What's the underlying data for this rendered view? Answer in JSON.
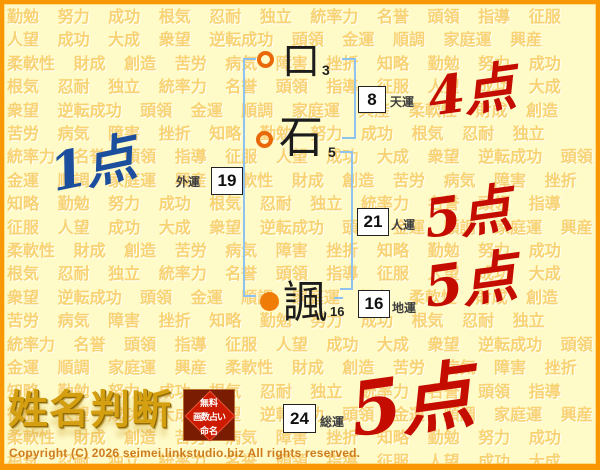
{
  "page": {
    "background_color": "#FFFBC9",
    "frame_color": "#F99803",
    "bracket_color": "#8FC2EE"
  },
  "watermark": {
    "color": "#F6C858",
    "words": [
      "勤勉",
      "努力",
      "成功",
      "根気",
      "忍耐",
      "独立",
      "統率力",
      "名誉",
      "頭領",
      "指導",
      "征服",
      "人望",
      "成功",
      "大成",
      "衆望",
      "逆転成功",
      "頭領",
      "金運",
      "順調",
      "家庭運",
      "興産",
      "柔軟性",
      "財成",
      "創造",
      "苦労",
      "病気",
      "障害",
      "挫折",
      "知略"
    ]
  },
  "name_chart": {
    "surname": [
      {
        "char": "口",
        "strokes": "3",
        "marker": "open-circle"
      },
      {
        "char": "石",
        "strokes": "5",
        "marker": "open-circle"
      }
    ],
    "given_name": [
      {
        "char": "諷",
        "strokes": "16",
        "marker": "filled-circle"
      }
    ],
    "fortunes": [
      {
        "id": "tenun",
        "label": "天運",
        "value": "8",
        "score": "4点",
        "score_color": "#C40D00"
      },
      {
        "id": "gaiun",
        "label": "外運",
        "value": "19",
        "score": "1点",
        "score_color": "#1C4E9E"
      },
      {
        "id": "jinun",
        "label": "人運",
        "value": "21",
        "score": "5点",
        "score_color": "#C40D00"
      },
      {
        "id": "chiun",
        "label": "地運",
        "value": "16",
        "score": "5点",
        "score_color": "#C40D00"
      },
      {
        "id": "soun",
        "label": "総運",
        "value": "24",
        "score": "5点",
        "score_color": "#C40D00"
      }
    ]
  },
  "logo": {
    "title": "姓名判断",
    "stamp_lines": [
      "無料",
      "画数占い",
      "命名"
    ]
  },
  "footer": {
    "copyright": "Copyright (C) 2026 seimei.linkstudio.biz All rights reserved."
  }
}
